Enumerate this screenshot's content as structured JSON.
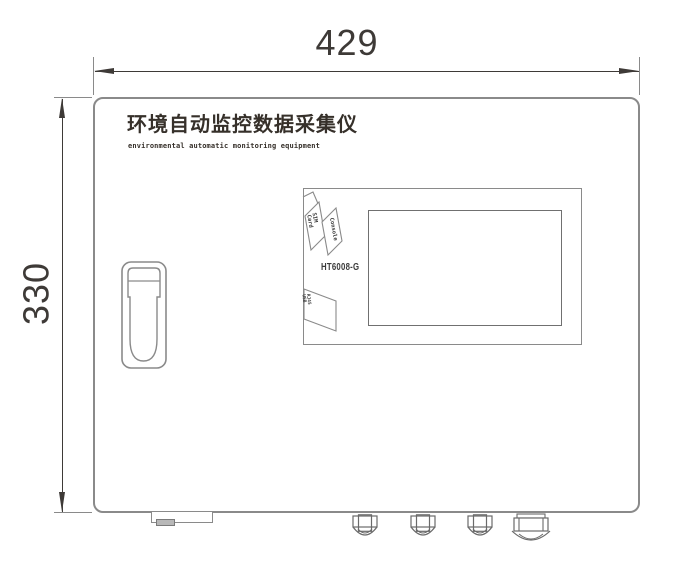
{
  "drawing": {
    "dimensions": {
      "width_mm": "429",
      "height_mm": "330"
    },
    "device": {
      "title_cn": "环境自动监控数据采集仪",
      "title_en": "environmental automatic monitoring equipment",
      "model": "HT6008-G"
    },
    "ports": {
      "console_label": "Console",
      "sim_label_line1": "SIM",
      "sim_label_line2": "Card",
      "lan_label_line1": "RJ45",
      "lan_label_line2": "USB"
    },
    "colors": {
      "outline": "#8a8a8a",
      "detail_line": "#6a6a6a",
      "dimension_line": "#3e3a37",
      "text": "#36302a",
      "background": "#ffffff"
    }
  }
}
